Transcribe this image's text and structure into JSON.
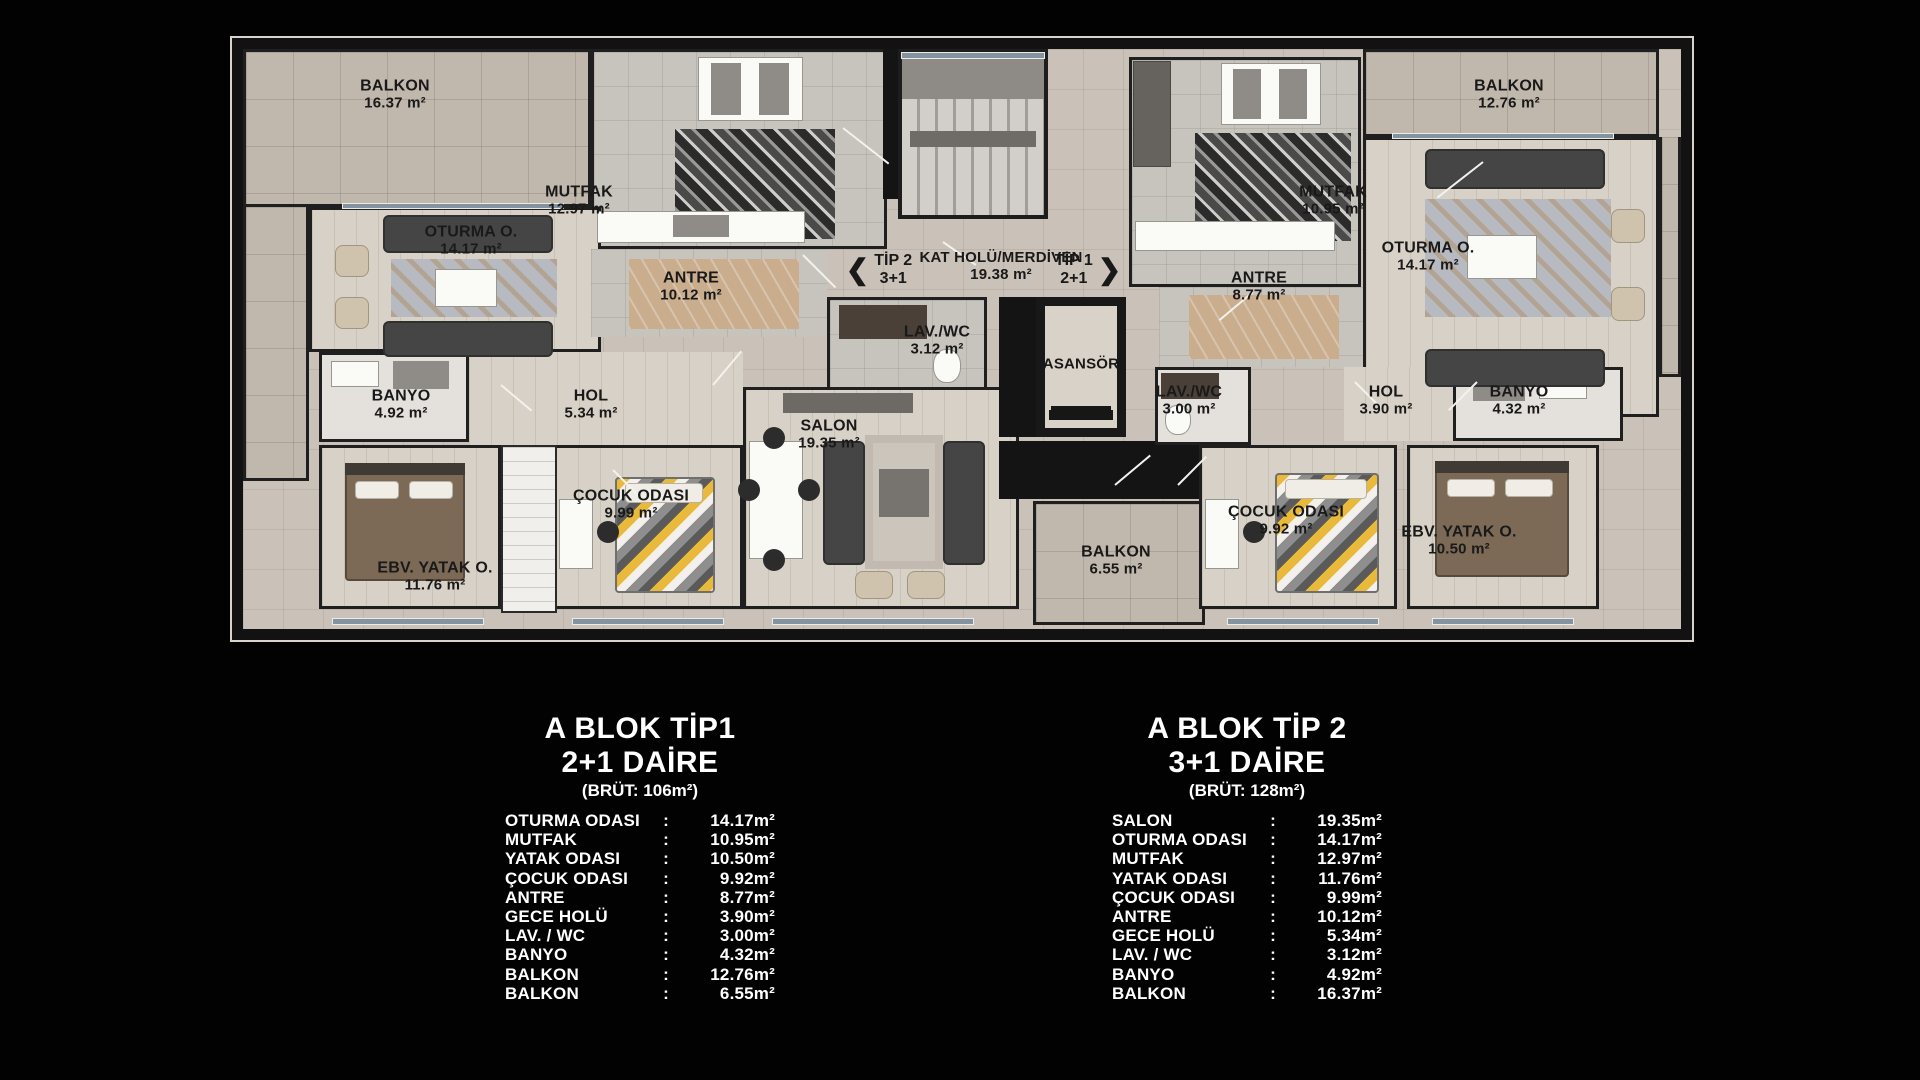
{
  "colon": ":",
  "plan": {
    "rooms": [
      {
        "id": "balkon-left",
        "name": "BALKON",
        "area": "16.37 m²"
      },
      {
        "id": "mutfak-left",
        "name": "MUTFAK",
        "area": "12.97 m²"
      },
      {
        "id": "oturma-left",
        "name": "OTURMA O.",
        "area": "14.17 m²"
      },
      {
        "id": "antre-left",
        "name": "ANTRE",
        "area": "10.12 m²"
      },
      {
        "id": "lavwc-left",
        "name": "LAV./WC",
        "area": "3.12 m²"
      },
      {
        "id": "banyo-left",
        "name": "BANYO",
        "area": "4.92 m²"
      },
      {
        "id": "hol-left",
        "name": "HOL",
        "area": "5.34 m²"
      },
      {
        "id": "salon",
        "name": "SALON",
        "area": "19.35 m²"
      },
      {
        "id": "cocuk-left",
        "name": "ÇOCUK ODASI",
        "area": "9.99 m²"
      },
      {
        "id": "ebv-left",
        "name": "EBV. YATAK O.",
        "area": "11.76 m²"
      },
      {
        "id": "kat-holu",
        "name": "KAT HOLÜ/MERDİVEN",
        "area": "19.38 m²"
      },
      {
        "id": "asansor",
        "name": "ASANSÖR",
        "area": ""
      },
      {
        "id": "balkon-mid",
        "name": "BALKON",
        "area": "6.55 m²"
      },
      {
        "id": "mutfak-right",
        "name": "MUTFAK",
        "area": "10.95 m²"
      },
      {
        "id": "antre-right",
        "name": "ANTRE",
        "area": "8.77 m²"
      },
      {
        "id": "oturma-right",
        "name": "OTURMA O.",
        "area": "14.17 m²"
      },
      {
        "id": "balkon-right",
        "name": "BALKON",
        "area": "12.76 m²"
      },
      {
        "id": "lavwc-right",
        "name": "LAV./WC",
        "area": "3.00 m²"
      },
      {
        "id": "hol-right",
        "name": "HOL",
        "area": "3.90 m²"
      },
      {
        "id": "banyo-right",
        "name": "BANYO",
        "area": "4.32 m²"
      },
      {
        "id": "cocuk-right",
        "name": "ÇOCUK ODASI",
        "area": "9.92 m²"
      },
      {
        "id": "ebv-right",
        "name": "EBV. YATAK O.",
        "area": "10.50 m²"
      }
    ],
    "nav": {
      "tip2_arrow": "❮",
      "tip2_name": "TİP 2",
      "tip2_sub": "3+1",
      "tip1_name": "TİP 1",
      "tip1_sub": "2+1",
      "tip1_arrow": "❯"
    }
  },
  "tables": [
    {
      "title1": "A BLOK TİP1",
      "title2": "2+1 DAİRE",
      "title3": "(BRÜT: 106m²)",
      "rows": [
        {
          "label": "OTURMA ODASI",
          "value": "14.17m²"
        },
        {
          "label": "MUTFAK",
          "value": "10.95m²"
        },
        {
          "label": "YATAK ODASI",
          "value": "10.50m²"
        },
        {
          "label": "ÇOCUK ODASI",
          "value": "9.92m²"
        },
        {
          "label": "ANTRE",
          "value": "8.77m²"
        },
        {
          "label": "GECE HOLÜ",
          "value": "3.90m²"
        },
        {
          "label": "LAV. / WC",
          "value": "3.00m²"
        },
        {
          "label": "BANYO",
          "value": "4.32m²"
        },
        {
          "label": "BALKON",
          "value": "12.76m²"
        },
        {
          "label": "BALKON",
          "value": "6.55m²"
        }
      ]
    },
    {
      "title1": "A BLOK TİP 2",
      "title2": "3+1 DAİRE",
      "title3": "(BRÜT: 128m²)",
      "rows": [
        {
          "label": "SALON",
          "value": "19.35m²"
        },
        {
          "label": "OTURMA ODASI",
          "value": "14.17m²"
        },
        {
          "label": "MUTFAK",
          "value": "12.97m²"
        },
        {
          "label": "YATAK ODASI",
          "value": "11.76m²"
        },
        {
          "label": "ÇOCUK ODASI",
          "value": "9.99m²"
        },
        {
          "label": "ANTRE",
          "value": "10.12m²"
        },
        {
          "label": "GECE HOLÜ",
          "value": "5.34m²"
        },
        {
          "label": "LAV. / WC",
          "value": "3.12m²"
        },
        {
          "label": "BANYO",
          "value": "4.92m²"
        },
        {
          "label": "BALKON",
          "value": "16.37m²"
        }
      ]
    }
  ]
}
